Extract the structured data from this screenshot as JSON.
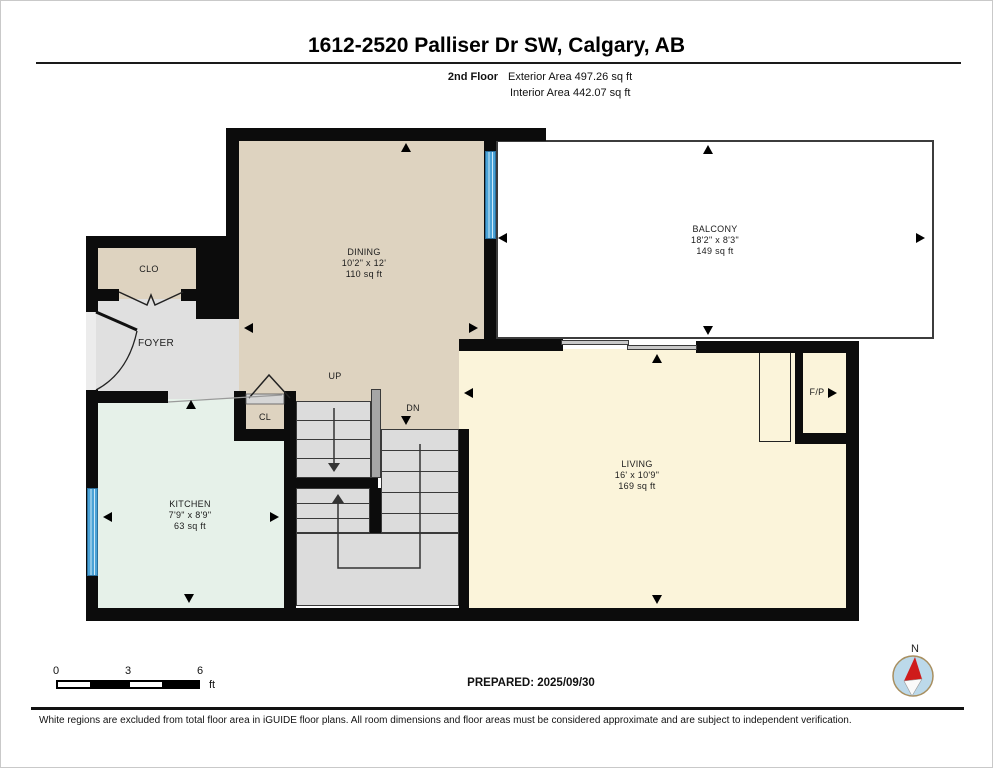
{
  "header": {
    "title": "1612-2520 Palliser Dr SW, Calgary, AB",
    "floor_label": "2nd Floor",
    "exterior_area": "Exterior Area 497.26 sq ft",
    "interior_area": "Interior Area 442.07 sq ft"
  },
  "rooms": {
    "dining": {
      "name": "DINING",
      "dims": "10'2\" x 12'",
      "area": "110 sq ft"
    },
    "balcony": {
      "name": "BALCONY",
      "dims": "18'2\" x 8'3\"",
      "area": "149 sq ft"
    },
    "kitchen": {
      "name": "KITCHEN",
      "dims": "7'9\" x 8'9\"",
      "area": "63 sq ft"
    },
    "living": {
      "name": "LIVING",
      "dims": "16' x 10'9\"",
      "area": "169 sq ft"
    },
    "foyer": {
      "name": "FOYER"
    },
    "clo": {
      "name": "CLO"
    },
    "cl": {
      "name": "CL"
    },
    "fireplace": {
      "name": "F/P"
    }
  },
  "stairs": {
    "up_label": "UP",
    "down_label": "DN"
  },
  "scale_bar": {
    "ticks": [
      "0",
      "3",
      "6"
    ],
    "unit": "ft"
  },
  "footer": {
    "prepared": "PREPARED: 2025/09/30",
    "compass_north": "N",
    "disclaimer": "White regions are excluded from total floor area in iGUIDE floor plans. All room dimensions and floor areas must be considered approximate and are subject to independent verification."
  },
  "colors": {
    "wall": "#0c0c0c",
    "dining": "#ded3c0",
    "kitchen": "#e6f1e9",
    "living": "#fbf4da",
    "foyer": "#e0e0e0",
    "stairs": "#dcdcdc",
    "railing": "#a6a6a6",
    "window": "#4aa2d6",
    "balcony-border": "#3c3c3c"
  }
}
